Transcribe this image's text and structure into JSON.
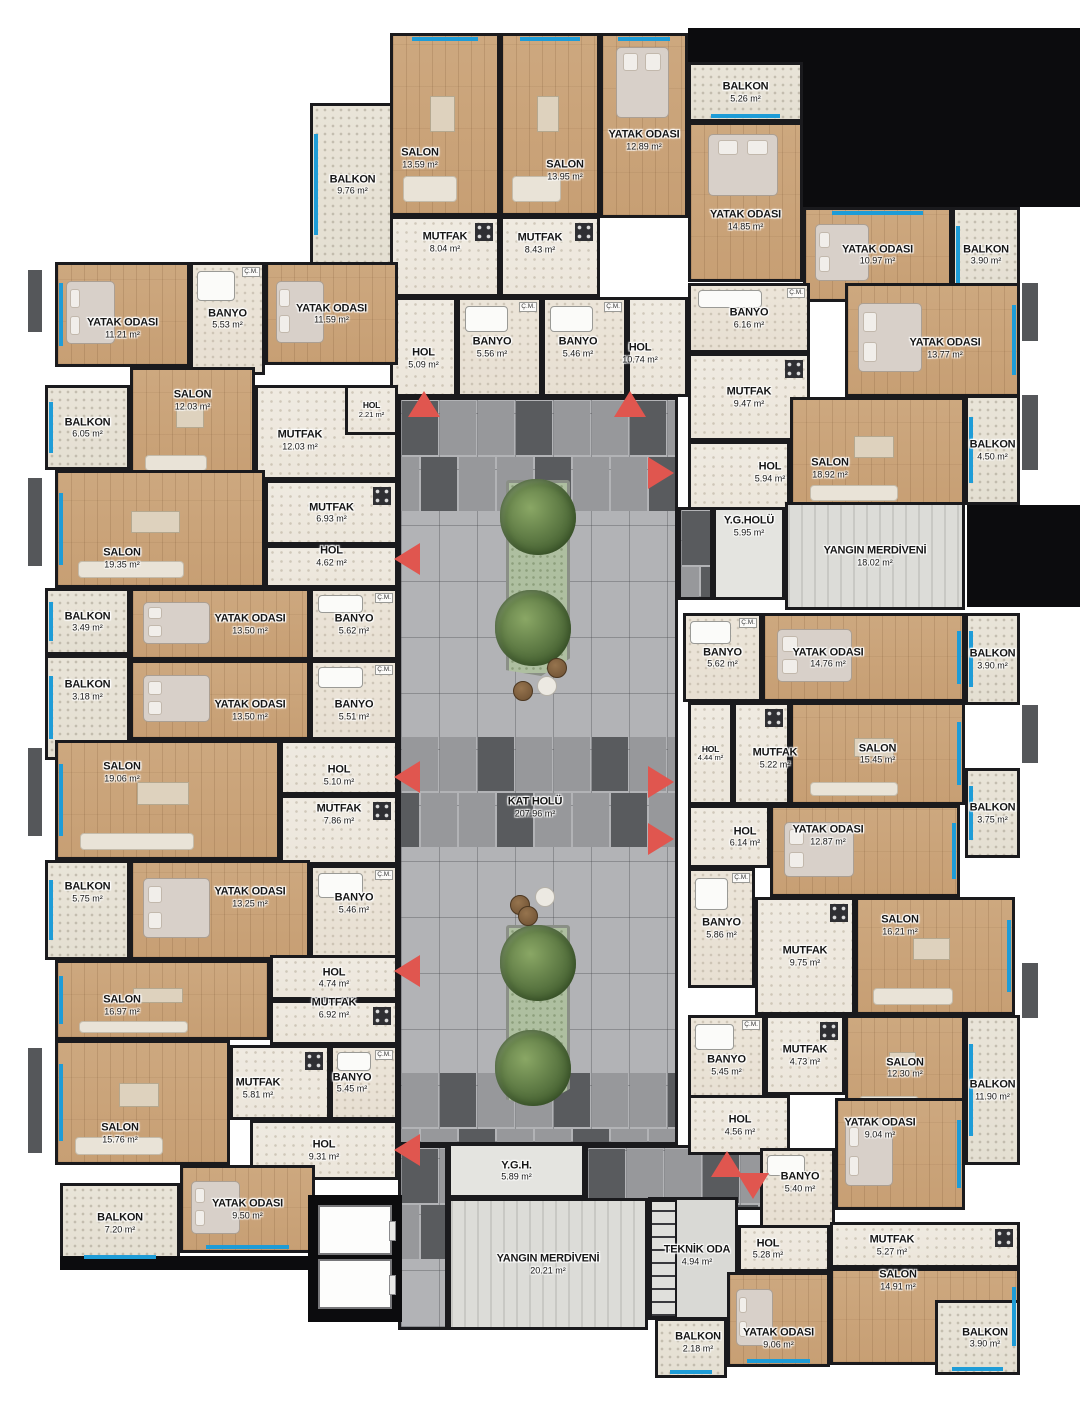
{
  "canvas": {
    "width": 1080,
    "height": 1424,
    "background": "#ffffff"
  },
  "palette": {
    "wall": "#1a1a1d",
    "wood": "#cda87f",
    "tile": "#efeae1",
    "balcony": "#e9e4d8",
    "corridor_base": "#b2b3b6",
    "corridor_mid": "#97989b",
    "corridor_dark": "#595b5e",
    "stairs": "#dcdcd8",
    "window_blue": "#1e9cd7",
    "arrow_red": "#e0564f",
    "black": "#0c0c0e"
  },
  "misc": {
    "cm_label": "Ç.M.",
    "unit": "m²"
  },
  "corridors": [
    {
      "name": "KAT HOLÜ",
      "area": "207.96 m²",
      "x": 398,
      "y": 397,
      "w": 280,
      "h": 748,
      "lx": 535,
      "ly": 807
    },
    {
      "x": 398,
      "y": 1145,
      "w": 50,
      "h": 185
    },
    {
      "x": 585,
      "y": 1145,
      "w": 190,
      "h": 65
    },
    {
      "x": 678,
      "y": 507,
      "w": 35,
      "h": 93
    }
  ],
  "rooms": [
    {
      "name": "BALKON",
      "area": "9.76 m²",
      "x": 310,
      "y": 103,
      "w": 85,
      "h": 163,
      "type": "balcony",
      "win": [
        "left"
      ]
    },
    {
      "name": "SALON",
      "area": "13.59 m²",
      "x": 390,
      "y": 33,
      "w": 110,
      "h": 183,
      "type": "wood",
      "win": [
        "top"
      ],
      "sofa": true,
      "lx": 420,
      "ly": 158
    },
    {
      "name": "MUTFAK",
      "area": "8.04 m²",
      "x": 390,
      "y": 216,
      "w": 110,
      "h": 81,
      "type": "tile",
      "kitchen": true,
      "ly": 242
    },
    {
      "name": "HOL",
      "area": "5.09 m²",
      "x": 390,
      "y": 297,
      "w": 67,
      "h": 100,
      "type": "tile",
      "ly": 358
    },
    {
      "name": "BANYO",
      "area": "5.56 m²",
      "x": 457,
      "y": 297,
      "w": 85,
      "h": 100,
      "type": "bath",
      "cm": true,
      "lx": 492
    },
    {
      "name": "SALON",
      "area": "13.95 m²",
      "x": 500,
      "y": 33,
      "w": 100,
      "h": 183,
      "type": "wood",
      "win": [
        "top"
      ],
      "sofa": true,
      "lx": 565,
      "ly": 170
    },
    {
      "name": "YATAK ODASI",
      "area": "12.89 m²",
      "x": 600,
      "y": 33,
      "w": 88,
      "h": 185,
      "type": "wood",
      "win": [
        "top"
      ],
      "bed": true,
      "ly": 140
    },
    {
      "name": "MUTFAK",
      "area": "8.43 m²",
      "x": 500,
      "y": 216,
      "w": 100,
      "h": 81,
      "type": "tile",
      "kitchen": true,
      "lx": 540,
      "ly": 243
    },
    {
      "name": "BANYO",
      "area": "5.46 m²",
      "x": 542,
      "y": 297,
      "w": 85,
      "h": 100,
      "type": "bath",
      "cm": true,
      "lx": 578
    },
    {
      "name": "HOL",
      "area": "10.74 m²",
      "x": 627,
      "y": 297,
      "w": 61,
      "h": 100,
      "type": "tile",
      "lx": 640,
      "ly": 353
    },
    {
      "name": "BALKON",
      "area": "5.26 m²",
      "x": 688,
      "y": 62,
      "w": 115,
      "h": 60,
      "type": "balcony",
      "win": [
        "bottom"
      ]
    },
    {
      "name": "YATAK ODASI",
      "area": "14.85 m²",
      "x": 688,
      "y": 122,
      "w": 115,
      "h": 160,
      "type": "wood",
      "bed": true,
      "ly": 220
    },
    {
      "name": "YATAK ODASI",
      "area": "10.97 m²",
      "x": 803,
      "y": 207,
      "w": 149,
      "h": 95,
      "type": "wood",
      "win": [
        "top"
      ],
      "bed": true
    },
    {
      "name": "BALKON",
      "area": "3.90 m²",
      "x": 952,
      "y": 207,
      "w": 68,
      "h": 95,
      "type": "balcony",
      "win": [
        "left"
      ]
    },
    {
      "name": "BANYO",
      "area": "6.16 m²",
      "x": 688,
      "y": 283,
      "w": 122,
      "h": 70,
      "type": "bath",
      "cm": true
    },
    {
      "name": "MUTFAK",
      "area": "9.47 m²",
      "x": 688,
      "y": 353,
      "w": 122,
      "h": 88,
      "type": "tile",
      "kitchen": true
    },
    {
      "name": "YATAK ODASI",
      "area": "13.77 m²",
      "x": 845,
      "y": 283,
      "w": 175,
      "h": 114,
      "type": "wood",
      "win": [
        "right"
      ],
      "bed": true,
      "lx": 945,
      "ly": 348
    },
    {
      "name": "HOL",
      "area": "5.94 m²",
      "x": 688,
      "y": 441,
      "w": 102,
      "h": 69,
      "type": "tile",
      "lx": 770,
      "ly": 472
    },
    {
      "name": "SALON",
      "area": "18.92 m²",
      "x": 790,
      "y": 397,
      "w": 175,
      "h": 113,
      "type": "wood",
      "sofa": true,
      "lx": 830,
      "ly": 468
    },
    {
      "name": "BALKON",
      "area": "4.50 m²",
      "x": 965,
      "y": 395,
      "w": 55,
      "h": 110,
      "type": "balcony",
      "win": [
        "left"
      ]
    },
    {
      "name": "Y.G.HOLÜ",
      "area": "5.95 m²",
      "x": 713,
      "y": 507,
      "w": 72,
      "h": 93,
      "type": "lobby",
      "ly": 526
    },
    {
      "name": "YANGIN MERDİVENİ",
      "area": "18.02 m²",
      "x": 785,
      "y": 502,
      "w": 180,
      "h": 108,
      "type": "stairs"
    },
    {
      "name": "BANYO",
      "area": "5.62 m²",
      "x": 683,
      "y": 613,
      "w": 79,
      "h": 89,
      "type": "bath",
      "cm": true
    },
    {
      "name": "YATAK ODASI",
      "area": "14.76 m²",
      "x": 762,
      "y": 613,
      "w": 203,
      "h": 89,
      "type": "wood",
      "win": [
        "right"
      ],
      "bed": true,
      "lx": 828
    },
    {
      "name": "BALKON",
      "area": "3.90 m²",
      "x": 965,
      "y": 613,
      "w": 55,
      "h": 92,
      "type": "balcony",
      "win": [
        "left"
      ]
    },
    {
      "name": "HOL",
      "area": "4.44 m²",
      "x": 688,
      "y": 702,
      "w": 45,
      "h": 103,
      "type": "tile",
      "sm": true
    },
    {
      "name": "MUTFAK",
      "area": "5.22 m²",
      "x": 733,
      "y": 702,
      "w": 57,
      "h": 103,
      "type": "tile",
      "kitchen": true,
      "lx": 775,
      "ly": 758
    },
    {
      "name": "SALON",
      "area": "15.45 m²",
      "x": 790,
      "y": 702,
      "w": 175,
      "h": 103,
      "type": "wood",
      "win": [
        "right"
      ],
      "sofa": true
    },
    {
      "name": "HOL",
      "area": "6.14 m²",
      "x": 688,
      "y": 805,
      "w": 82,
      "h": 63,
      "type": "tile",
      "lx": 745
    },
    {
      "name": "YATAK ODASI",
      "area": "12.87 m²",
      "x": 770,
      "y": 805,
      "w": 190,
      "h": 92,
      "type": "wood",
      "win": [
        "right"
      ],
      "bed": true,
      "lx": 828,
      "ly": 835
    },
    {
      "name": "BALKON",
      "area": "3.75 m²",
      "x": 965,
      "y": 768,
      "w": 55,
      "h": 90,
      "type": "balcony",
      "win": [
        "left"
      ]
    },
    {
      "name": "BANYO",
      "area": "5.86 m²",
      "x": 688,
      "y": 868,
      "w": 67,
      "h": 120,
      "type": "bath",
      "cm": true
    },
    {
      "name": "MUTFAK",
      "area": "9.75 m²",
      "x": 755,
      "y": 897,
      "w": 100,
      "h": 118,
      "type": "tile",
      "kitchen": true
    },
    {
      "name": "SALON",
      "area": "16.21 m²",
      "x": 855,
      "y": 897,
      "w": 160,
      "h": 118,
      "type": "wood",
      "win": [
        "right"
      ],
      "sofa": true,
      "lx": 900,
      "ly": 925
    },
    {
      "name": "BANYO",
      "area": "5.45 m²",
      "x": 688,
      "y": 1015,
      "w": 77,
      "h": 100,
      "type": "bath",
      "cm": true
    },
    {
      "name": "MUTFAK",
      "area": "4.73 m²",
      "x": 765,
      "y": 1015,
      "w": 80,
      "h": 80,
      "type": "tile",
      "kitchen": true
    },
    {
      "name": "SALON",
      "area": "12.30 m²",
      "x": 845,
      "y": 1015,
      "w": 120,
      "h": 105,
      "type": "wood",
      "sofa": true
    },
    {
      "name": "BALKON",
      "area": "11.90 m²",
      "x": 965,
      "y": 1015,
      "w": 55,
      "h": 150,
      "type": "balcony",
      "win": [
        "left"
      ]
    },
    {
      "name": "HOL",
      "area": "4.56 m²",
      "x": 688,
      "y": 1095,
      "w": 102,
      "h": 60,
      "type": "tile",
      "lx": 740
    },
    {
      "name": "YATAK ODASI",
      "area": "9.04 m²",
      "x": 835,
      "y": 1098,
      "w": 130,
      "h": 112,
      "type": "wood",
      "win": [
        "right"
      ],
      "bed": true,
      "lx": 880,
      "ly": 1128
    },
    {
      "name": "BANYO",
      "area": "5.40 m²",
      "x": 760,
      "y": 1148,
      "w": 75,
      "h": 80,
      "type": "bath",
      "lx": 800,
      "ly": 1182
    },
    {
      "name": "TEKNİK ODA",
      "area": "4.94 m²",
      "x": 648,
      "y": 1197,
      "w": 90,
      "h": 123,
      "type": "tech",
      "lx": 697,
      "ly": 1255
    },
    {
      "name": "HOL",
      "area": "5.28 m²",
      "x": 738,
      "y": 1225,
      "w": 92,
      "h": 47,
      "type": "tile",
      "lx": 768
    },
    {
      "name": "MUTFAK",
      "area": "5.27 m²",
      "x": 830,
      "y": 1222,
      "w": 190,
      "h": 46,
      "type": "tile",
      "kitchen": true,
      "lx": 892
    },
    {
      "name": "SALON",
      "area": "14.91 m²",
      "x": 830,
      "y": 1268,
      "w": 190,
      "h": 97,
      "type": "wood",
      "win": [
        "right"
      ],
      "lx": 898,
      "ly": 1280
    },
    {
      "name": "YATAK ODASI",
      "area": "9.06 m²",
      "x": 727,
      "y": 1272,
      "w": 103,
      "h": 95,
      "type": "wood",
      "win": [
        "bottom"
      ],
      "bed": true,
      "ly": 1338
    },
    {
      "name": "BALKON",
      "area": "2.18 m²",
      "x": 655,
      "y": 1318,
      "w": 72,
      "h": 60,
      "type": "balcony",
      "win": [
        "bottom"
      ],
      "lx": 698,
      "ly": 1342
    },
    {
      "name": "BALKON",
      "area": "3.90 m²",
      "x": 935,
      "y": 1300,
      "w": 85,
      "h": 75,
      "type": "balcony",
      "win": [
        "bottom"
      ],
      "lx": 985
    },
    {
      "name": "Y.G.H.",
      "area": "5.89 m²",
      "x": 448,
      "y": 1143,
      "w": 137,
      "h": 55,
      "type": "lobby"
    },
    {
      "name": "YANGIN MERDİVENİ",
      "area": "20.21 m²",
      "x": 448,
      "y": 1198,
      "w": 200,
      "h": 132,
      "type": "stairs"
    },
    {
      "name": "YATAK ODASI",
      "area": "11.21 m²",
      "x": 55,
      "y": 262,
      "w": 135,
      "h": 105,
      "type": "wood",
      "win": [
        "left"
      ],
      "bed": true,
      "ly": 328
    },
    {
      "name": "BANYO",
      "area": "5.53 m²",
      "x": 190,
      "y": 262,
      "w": 75,
      "h": 113,
      "type": "bath",
      "cm": true
    },
    {
      "name": "YATAK ODASI",
      "area": "11.59 m²",
      "x": 265,
      "y": 262,
      "w": 133,
      "h": 103,
      "type": "wood",
      "bed": true
    },
    {
      "name": "BALKON",
      "area": "6.05 m²",
      "x": 45,
      "y": 385,
      "w": 85,
      "h": 85,
      "type": "balcony",
      "win": [
        "left"
      ]
    },
    {
      "name": "SALON",
      "area": "12.03 m²",
      "x": 130,
      "y": 367,
      "w": 125,
      "h": 113,
      "type": "wood",
      "sofa": true,
      "ly": 400
    },
    {
      "name": "MUTFAK",
      "area": "12.03 m²",
      "x": 255,
      "y": 385,
      "w": 143,
      "h": 95,
      "type": "tile",
      "kitchen": true,
      "lx": 300,
      "ly": 440
    },
    {
      "name": "HOL",
      "area": "2.21 m²",
      "x": 345,
      "y": 385,
      "w": 53,
      "h": 50,
      "type": "tile",
      "sm": true
    },
    {
      "name": "SALON",
      "area": "19.35 m²",
      "x": 55,
      "y": 470,
      "w": 210,
      "h": 118,
      "type": "wood",
      "win": [
        "left"
      ],
      "sofa": true,
      "lx": 122,
      "ly": 558
    },
    {
      "name": "MUTFAK",
      "area": "6.93 m²",
      "x": 265,
      "y": 480,
      "w": 133,
      "h": 65,
      "type": "tile",
      "kitchen": true
    },
    {
      "name": "HOL",
      "area": "4.62 m²",
      "x": 265,
      "y": 545,
      "w": 133,
      "h": 43,
      "type": "tile",
      "ly": 556
    },
    {
      "name": "BALKON",
      "area": "3.49 m²",
      "x": 45,
      "y": 588,
      "w": 85,
      "h": 67,
      "type": "balcony",
      "win": [
        "left"
      ]
    },
    {
      "name": "YATAK ODASI",
      "area": "13.50 m²",
      "x": 130,
      "y": 588,
      "w": 180,
      "h": 72,
      "type": "wood",
      "bed": true,
      "lx": 250
    },
    {
      "name": "BANYO",
      "area": "5.62 m²",
      "x": 310,
      "y": 588,
      "w": 88,
      "h": 72,
      "type": "bath",
      "cm": true
    },
    {
      "name": "BALKON",
      "area": "3.18 m²",
      "x": 45,
      "y": 655,
      "w": 85,
      "h": 105,
      "type": "balcony",
      "win": [
        "left"
      ],
      "ly": 690
    },
    {
      "name": "YATAK ODASI",
      "area": "13.50 m²",
      "x": 130,
      "y": 660,
      "w": 180,
      "h": 80,
      "type": "wood",
      "bed": true,
      "lx": 250,
      "ly": 710
    },
    {
      "name": "BANYO",
      "area": "5.51 m²",
      "x": 310,
      "y": 660,
      "w": 88,
      "h": 80,
      "type": "bath",
      "cm": true,
      "ly": 710
    },
    {
      "name": "SALON",
      "area": "19.06 m²",
      "x": 55,
      "y": 740,
      "w": 225,
      "h": 120,
      "type": "wood",
      "win": [
        "left"
      ],
      "sofa": true,
      "lx": 122,
      "ly": 772
    },
    {
      "name": "HOL",
      "area": "5.10 m²",
      "x": 280,
      "y": 740,
      "w": 118,
      "h": 55,
      "type": "tile",
      "ly": 775
    },
    {
      "name": "MUTFAK",
      "area": "7.86 m²",
      "x": 280,
      "y": 795,
      "w": 118,
      "h": 70,
      "type": "tile",
      "kitchen": true,
      "ly": 814
    },
    {
      "name": "BALKON",
      "area": "5.75 m²",
      "x": 45,
      "y": 860,
      "w": 85,
      "h": 100,
      "type": "balcony",
      "win": [
        "left"
      ],
      "ly": 892
    },
    {
      "name": "YATAK ODASI",
      "area": "13.25 m²",
      "x": 130,
      "y": 860,
      "w": 180,
      "h": 100,
      "type": "wood",
      "bed": true,
      "lx": 250,
      "ly": 897
    },
    {
      "name": "BANYO",
      "area": "5.46 m²",
      "x": 310,
      "y": 865,
      "w": 88,
      "h": 95,
      "type": "bath",
      "cm": true,
      "ly": 903
    },
    {
      "name": "SALON",
      "area": "16.97 m²",
      "x": 55,
      "y": 960,
      "w": 215,
      "h": 80,
      "type": "wood",
      "win": [
        "left"
      ],
      "sofa": true,
      "lx": 122,
      "ly": 1005
    },
    {
      "name": "HOL",
      "area": "4.74 m²",
      "x": 270,
      "y": 955,
      "w": 128,
      "h": 45,
      "type": "tile"
    },
    {
      "name": "MUTFAK",
      "area": "6.92 m²",
      "x": 270,
      "y": 1000,
      "w": 128,
      "h": 45,
      "type": "tile",
      "kitchen": true,
      "ly": 1008
    },
    {
      "name": "SALON",
      "area": "15.76 m²",
      "x": 55,
      "y": 1040,
      "w": 175,
      "h": 125,
      "type": "wood",
      "win": [
        "left"
      ],
      "sofa": true,
      "lx": 120,
      "ly": 1133
    },
    {
      "name": "MUTFAK",
      "area": "5.81 m²",
      "x": 230,
      "y": 1045,
      "w": 100,
      "h": 75,
      "type": "tile",
      "kitchen": true,
      "lx": 258,
      "ly": 1088
    },
    {
      "name": "BANYO",
      "area": "5.45 m²",
      "x": 330,
      "y": 1045,
      "w": 68,
      "h": 75,
      "type": "bath",
      "cm": true,
      "lx": 352
    },
    {
      "name": "HOL",
      "area": "9.31 m²",
      "x": 250,
      "y": 1120,
      "w": 148,
      "h": 60,
      "type": "tile"
    },
    {
      "name": "YATAK ODASI",
      "area": "9.50 m²",
      "x": 180,
      "y": 1165,
      "w": 135,
      "h": 88,
      "type": "wood",
      "win": [
        "bottom"
      ],
      "bed": true
    },
    {
      "name": "BALKON",
      "area": "7.20 m²",
      "x": 60,
      "y": 1183,
      "w": 120,
      "h": 80,
      "type": "balcony",
      "win": [
        "bottom"
      ]
    }
  ],
  "fillers": [
    {
      "x": 688,
      "y": 28,
      "w": 392,
      "h": 34,
      "tone": "black"
    },
    {
      "x": 795,
      "y": 28,
      "w": 285,
      "h": 179,
      "tone": "black"
    },
    {
      "x": 967,
      "y": 505,
      "w": 113,
      "h": 102,
      "tone": "black"
    },
    {
      "x": 1022,
      "y": 283,
      "w": 16,
      "h": 58,
      "tone": "gray"
    },
    {
      "x": 1022,
      "y": 395,
      "w": 16,
      "h": 75,
      "tone": "gray"
    },
    {
      "x": 1022,
      "y": 705,
      "w": 16,
      "h": 58,
      "tone": "gray"
    },
    {
      "x": 1022,
      "y": 963,
      "w": 16,
      "h": 55,
      "tone": "gray"
    },
    {
      "x": 28,
      "y": 270,
      "w": 14,
      "h": 62,
      "tone": "gray"
    },
    {
      "x": 28,
      "y": 478,
      "w": 14,
      "h": 88,
      "tone": "gray"
    },
    {
      "x": 28,
      "y": 748,
      "w": 14,
      "h": 88,
      "tone": "gray"
    },
    {
      "x": 28,
      "y": 1048,
      "w": 14,
      "h": 105,
      "tone": "gray"
    },
    {
      "x": 60,
      "y": 1256,
      "w": 255,
      "h": 14,
      "tone": "black",
      "layer": "over"
    },
    {
      "x": 308,
      "y": 1195,
      "w": 94,
      "h": 127,
      "tone": "black",
      "layer": "over"
    }
  ],
  "elevators": [
    {
      "x": 318,
      "y": 1205,
      "w": 74,
      "h": 50
    },
    {
      "x": 318,
      "y": 1259,
      "w": 74,
      "h": 50
    }
  ],
  "ladder": {
    "x": 650,
    "y": 1200,
    "w": 27,
    "h": 118
  },
  "planters": [
    {
      "x": 506,
      "y": 480,
      "w": 64,
      "h": 196,
      "trees": [
        [
          538,
          517
        ],
        [
          533,
          628
        ]
      ],
      "pots": [
        [
          557,
          668,
          "brown"
        ],
        [
          547,
          686,
          "white"
        ],
        [
          523,
          691,
          "brown"
        ]
      ]
    },
    {
      "x": 506,
      "y": 925,
      "w": 64,
      "h": 180,
      "trees": [
        [
          538,
          963
        ],
        [
          533,
          1068
        ]
      ],
      "pots": [
        [
          520,
          905,
          "brown"
        ],
        [
          545,
          897,
          "white"
        ],
        [
          528,
          916,
          "brown"
        ]
      ]
    }
  ],
  "arrows": [
    {
      "dir": "up",
      "x": 424,
      "y": 404
    },
    {
      "dir": "up",
      "x": 630,
      "y": 404
    },
    {
      "dir": "right",
      "x": 664,
      "y": 470
    },
    {
      "dir": "right",
      "x": 664,
      "y": 779
    },
    {
      "dir": "right",
      "x": 664,
      "y": 836
    },
    {
      "dir": "left",
      "x": 410,
      "y": 556
    },
    {
      "dir": "left",
      "x": 410,
      "y": 774
    },
    {
      "dir": "left",
      "x": 410,
      "y": 968
    },
    {
      "dir": "left",
      "x": 410,
      "y": 1147
    },
    {
      "dir": "up",
      "x": 727,
      "y": 1164
    },
    {
      "dir": "down",
      "x": 753,
      "y": 1186
    }
  ]
}
